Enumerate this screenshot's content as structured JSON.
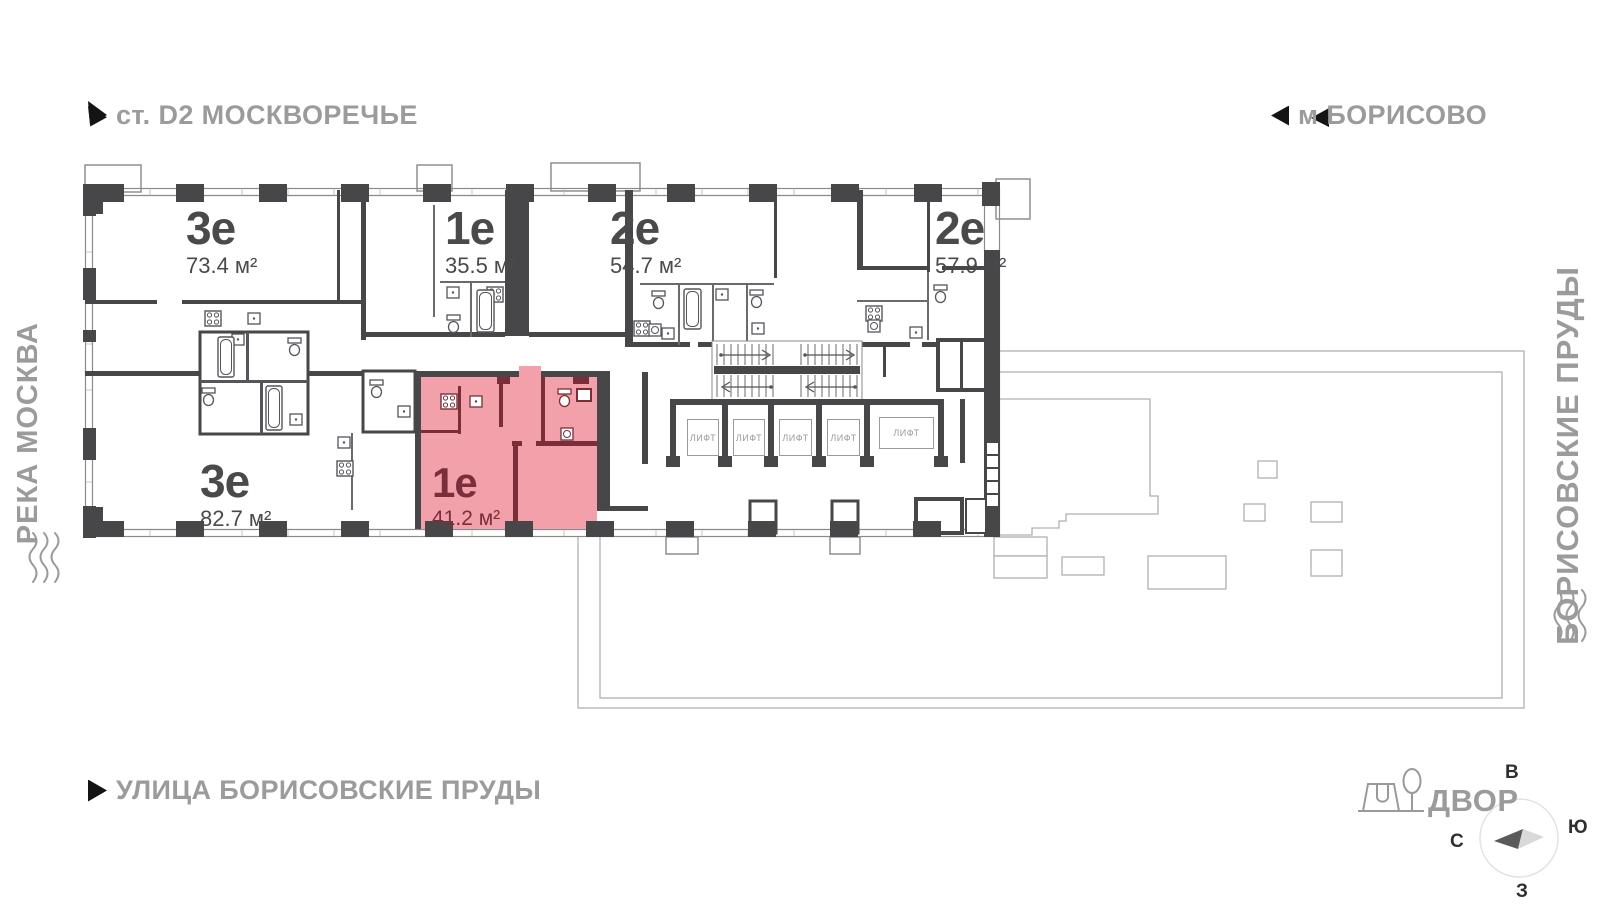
{
  "map_labels": {
    "station": "ст. D2 МОСКВОРЕЧЬЕ",
    "metro": "м БОРИСОВО",
    "river": "РЕКА МОСКВА",
    "ponds": "БОРИСОВСКИЕ ПРУДЫ",
    "street": "УЛИЦА БОРИСОВСКИЕ ПРУДЫ",
    "courtyard": "ДВОР"
  },
  "compass": {
    "east": "В",
    "south": "Ю",
    "north": "С",
    "west": "З"
  },
  "apartments": [
    {
      "type": "3е",
      "area": "73.4 м²",
      "highlighted": false
    },
    {
      "type": "1е",
      "area": "35.5 м²",
      "highlighted": false
    },
    {
      "type": "2е",
      "area": "54.7 м²",
      "highlighted": false
    },
    {
      "type": "2е",
      "area": "57.9 м²",
      "highlighted": false
    },
    {
      "type": "3е",
      "area": "82.7 м²",
      "highlighted": false
    },
    {
      "type": "1е",
      "area": "41.2 м²",
      "highlighted": true
    }
  ],
  "elevators": [
    "ЛИФТ",
    "ЛИФТ",
    "ЛИФТ",
    "ЛИФТ",
    "ЛИФТ"
  ],
  "colors": {
    "highlight_fill": "#F2A1AA",
    "highlight_wall": "#7A2E39",
    "wall": "#47474A",
    "muted_label": "#9B9B9B"
  }
}
